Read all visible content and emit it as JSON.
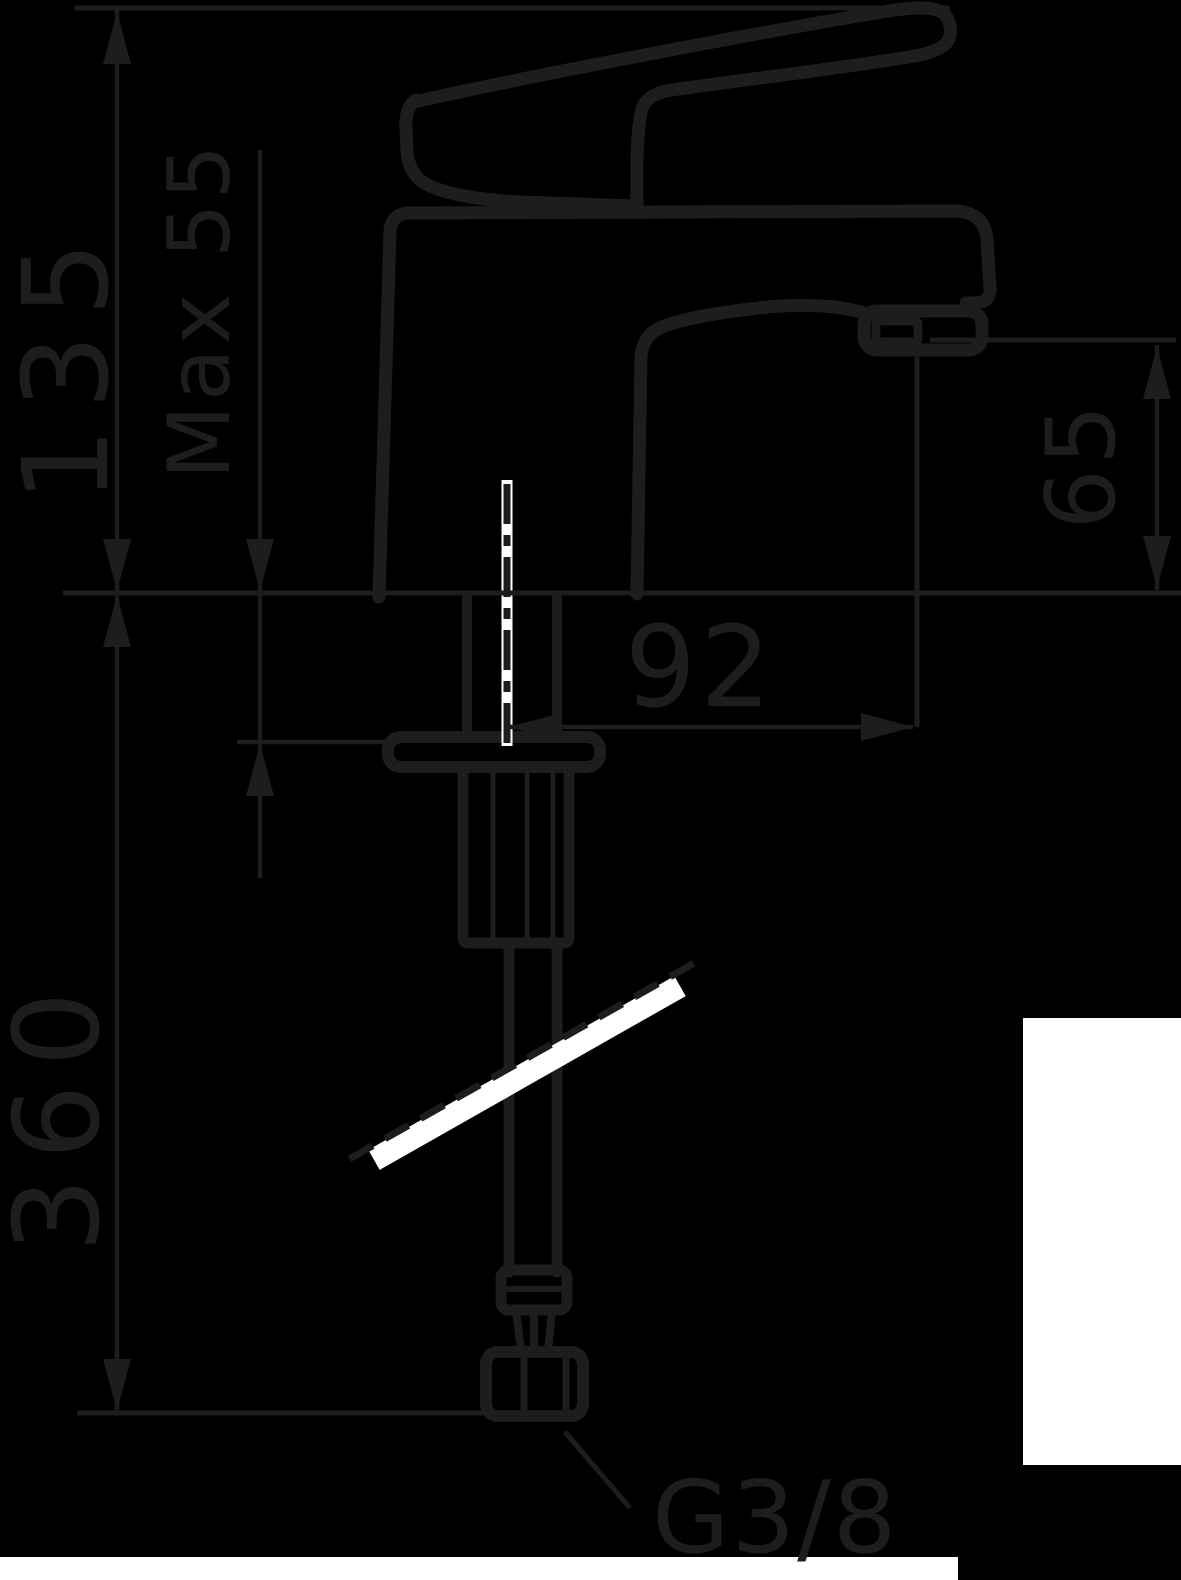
{
  "drawing": {
    "type": "technical-dimension-drawing",
    "subject": "single-lever basin faucet with flexible connection hose, side view",
    "labels": {
      "total_height": "135",
      "clamp_thickness": "Max 55",
      "spout_height": "65",
      "spout_reach": "92",
      "hose_length": "360",
      "thread": "G3/8"
    },
    "colors": {
      "background": "#000000",
      "line": "#1d1d1b",
      "highlight": "#ffffff"
    }
  }
}
